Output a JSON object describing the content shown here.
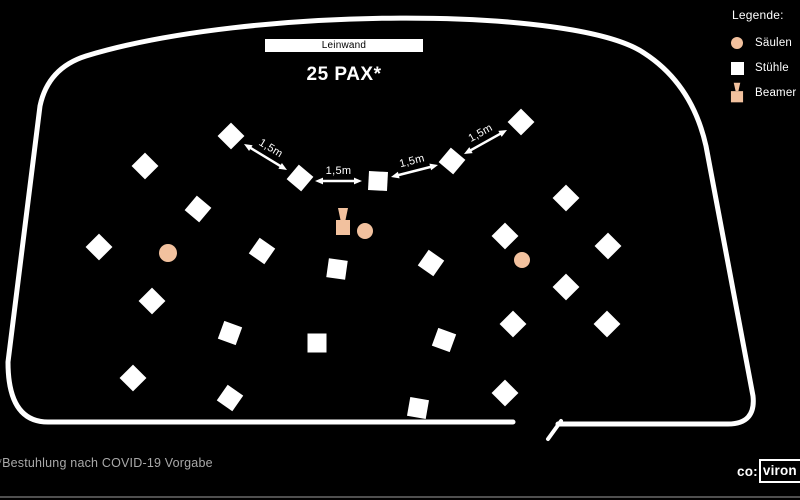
{
  "screen": {
    "label": "Leinwand"
  },
  "title": "25 PAX*",
  "legend": {
    "title": "Legende:",
    "items": [
      {
        "icon": "column-circle",
        "label": "Säulen"
      },
      {
        "icon": "chair-square",
        "label": "Stühle"
      },
      {
        "icon": "beamer",
        "label": "Beamer"
      }
    ]
  },
  "footnote": "*Bestuhlung nach COVID-19 Vorgabe",
  "logo": {
    "prefix": "co:",
    "boxed": "viron"
  },
  "colors": {
    "background": "#000000",
    "wall": "#FFFFFF",
    "chair": "#FFFFFF",
    "column": "#F2C19E",
    "arrow": "#FFFFFF",
    "footnote_text": "#A9A9A9"
  },
  "plan": {
    "room_outline_path": "M 558,424 L 728,424 Q 756,424 753,396 L 706,146 Q 692,84 644,53 C 575,6 250,6 86,56 Q 48,68 40,106 L 8,362 Q 8,422 48,422 L 513,422",
    "door_path": "M 548,439 L 561,421",
    "wall_stroke_width": 5,
    "door_stroke_width": 4,
    "chair_size": 19,
    "chairs": [
      {
        "x": 231,
        "y": 136,
        "r": 45
      },
      {
        "x": 300,
        "y": 178,
        "r": 40
      },
      {
        "x": 378,
        "y": 181,
        "r": 3
      },
      {
        "x": 452,
        "y": 161,
        "r": 40
      },
      {
        "x": 521,
        "y": 122,
        "r": 45
      },
      {
        "x": 145,
        "y": 166,
        "r": 45
      },
      {
        "x": 198,
        "y": 209,
        "r": 40
      },
      {
        "x": 99,
        "y": 247,
        "r": 45
      },
      {
        "x": 262,
        "y": 251,
        "r": 35
      },
      {
        "x": 152,
        "y": 301,
        "r": 45
      },
      {
        "x": 230,
        "y": 333,
        "r": 20
      },
      {
        "x": 133,
        "y": 378,
        "r": 45
      },
      {
        "x": 230,
        "y": 398,
        "r": 35
      },
      {
        "x": 337,
        "y": 269,
        "r": 8
      },
      {
        "x": 431,
        "y": 263,
        "r": 35
      },
      {
        "x": 317,
        "y": 343,
        "r": 0
      },
      {
        "x": 444,
        "y": 340,
        "r": 20
      },
      {
        "x": 418,
        "y": 408,
        "r": 10
      },
      {
        "x": 566,
        "y": 198,
        "r": 45
      },
      {
        "x": 505,
        "y": 236,
        "r": 45
      },
      {
        "x": 608,
        "y": 246,
        "r": 45
      },
      {
        "x": 566,
        "y": 287,
        "r": 45
      },
      {
        "x": 513,
        "y": 324,
        "r": 45
      },
      {
        "x": 607,
        "y": 324,
        "r": 45
      },
      {
        "x": 505,
        "y": 393,
        "r": 45
      }
    ],
    "columns": [
      {
        "x": 168,
        "y": 253,
        "r": 9
      },
      {
        "x": 365,
        "y": 231,
        "r": 8
      },
      {
        "x": 522,
        "y": 260,
        "r": 8
      }
    ],
    "beamer": {
      "x": 343,
      "y": 220
    },
    "arrow_label": "1,5m",
    "arrows": [
      {
        "x1": 244,
        "y1": 144,
        "x2": 287,
        "y2": 170
      },
      {
        "x1": 315,
        "y1": 181,
        "x2": 362,
        "y2": 181
      },
      {
        "x1": 391,
        "y1": 177,
        "x2": 438,
        "y2": 165
      },
      {
        "x1": 464,
        "y1": 154,
        "x2": 507,
        "y2": 130
      }
    ]
  }
}
